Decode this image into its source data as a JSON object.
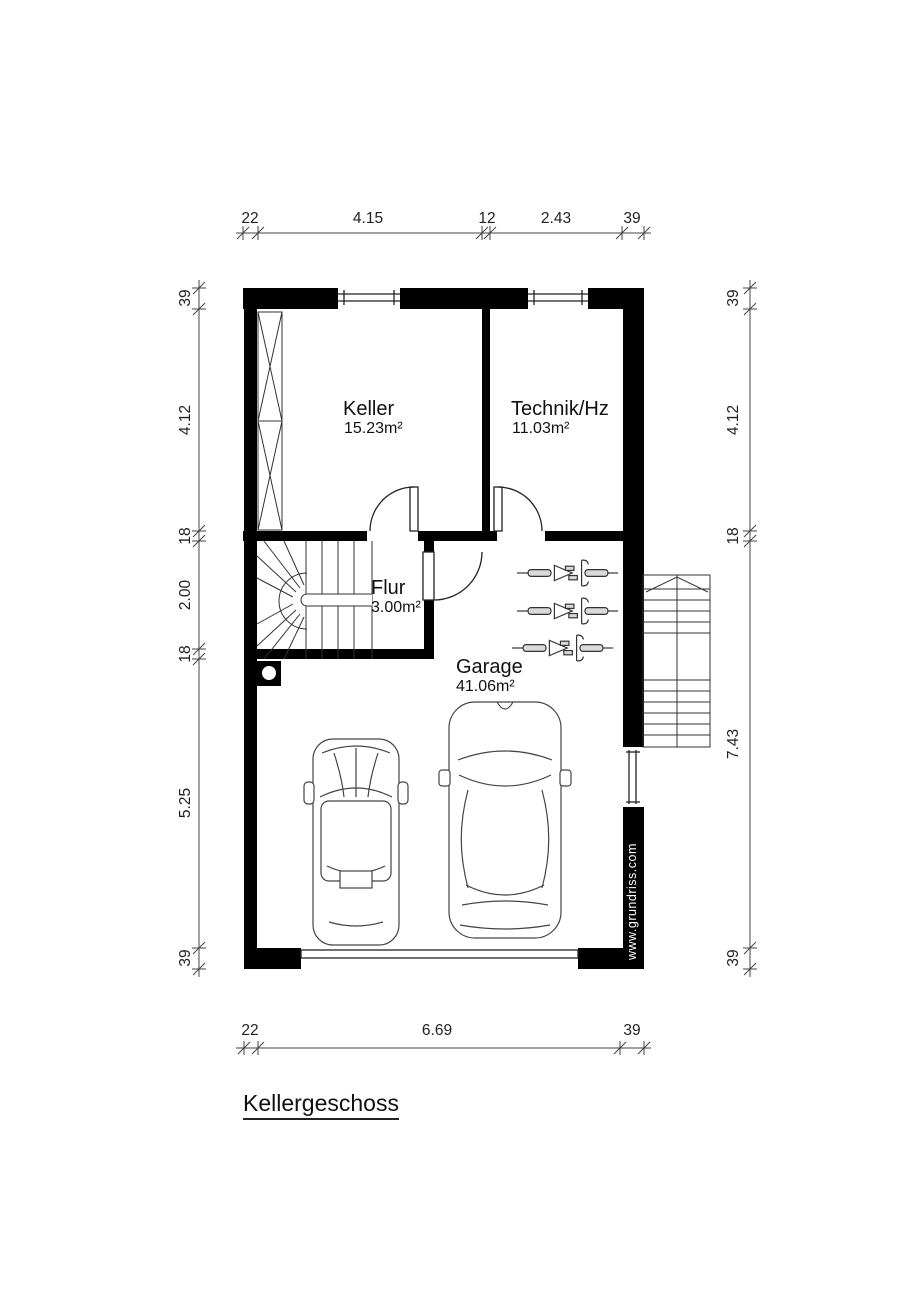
{
  "floor_title": "Kellergeschoss",
  "watermark": "www.grundriss.com",
  "rooms": [
    {
      "name": "Keller",
      "area": "15.23m²"
    },
    {
      "name": "Technik/Hz",
      "area": "11.03m²"
    },
    {
      "name": "Flur",
      "area": "3.00m²"
    },
    {
      "name": "Garage",
      "area": "41.06m²"
    }
  ],
  "dimensions": {
    "top": [
      "22",
      "4.15",
      "12",
      "2.43",
      "39"
    ],
    "bottom": [
      "22",
      "6.69",
      "39"
    ],
    "left": [
      "39",
      "4.12",
      "18",
      "2.00",
      "18",
      "5.25",
      "39"
    ],
    "right": [
      "39",
      "4.12",
      "18",
      "7.43",
      "39"
    ]
  },
  "symbols": [
    "window",
    "door-swing",
    "winder-stair",
    "exterior-stair",
    "shelf-unit",
    "column-post",
    "bicycle",
    "car-top-view",
    "garage-door"
  ],
  "colors": {
    "wall": "#000000",
    "thin_line": "#333333",
    "dim_line": "#444444",
    "text": "#111111",
    "watermark_text": "#ffffff",
    "background": "#ffffff"
  }
}
